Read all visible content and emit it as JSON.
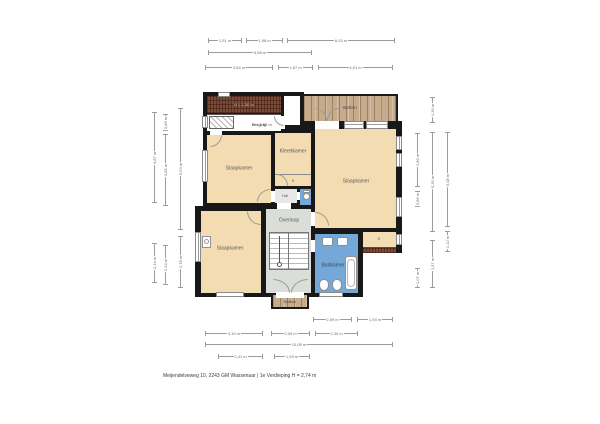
{
  "meta": {
    "caption": "Meijendelseweg 10, 2243 GM Wassenaar | 1e Verdieping H = 2,74 m"
  },
  "colors": {
    "wall": "#181818",
    "room_fill": "#f3dcb1",
    "wet_fill": "#74a8d9",
    "landing_fill": "#dbddd9",
    "hall_fill": "#e6e8e5",
    "roof_fill": "#7c4a36",
    "wood_fill": "#c6ab8c",
    "dim_line": "#9c9c9c",
    "dim_text": "#6e6e6e",
    "label_text": "#5c5c5c"
  },
  "rooms": {
    "slaapkamer_tl": {
      "label": "Slaapkamer"
    },
    "kleedkamer": {
      "label": "Kleedkamer"
    },
    "kast_mid": {
      "label": "K"
    },
    "hal": {
      "label": "Hal"
    },
    "slaapkamer_r": {
      "label": "Slaapkamer"
    },
    "overloop": {
      "label": "Overloop"
    },
    "slaapkamer_bl": {
      "label": "Slaapkamer"
    },
    "badkamer": {
      "label": "Badkamer"
    },
    "kast_r": {
      "label": "K"
    },
    "balkon_top": {
      "label": "Balkon"
    },
    "balkon_bottom": {
      "label": "Balkon"
    },
    "berging": {
      "label": "Berging",
      "height_note": "H = 1,50 m"
    },
    "roof": {
      "height_note": "H < 1,50 m"
    }
  },
  "dimensions": [
    {
      "o": "h",
      "x": 208,
      "y": 40,
      "len": 34,
      "label": "1,51 m"
    },
    {
      "o": "h",
      "x": 246,
      "y": 40,
      "len": 37,
      "label": "1,98 m"
    },
    {
      "o": "h",
      "x": 287,
      "y": 40,
      "len": 108,
      "label": "6,03 m"
    },
    {
      "o": "h",
      "x": 208,
      "y": 52,
      "len": 104,
      "label": "5,58 m"
    },
    {
      "o": "h",
      "x": 205,
      "y": 67,
      "len": 68,
      "label": "3,64 m"
    },
    {
      "o": "h",
      "x": 278,
      "y": 67,
      "len": 35,
      "label": "1,87 m"
    },
    {
      "o": "h",
      "x": 318,
      "y": 67,
      "len": 75,
      "label": "4,01 m"
    },
    {
      "o": "v",
      "x": 154,
      "y": 112,
      "len": 91,
      "label": "4,87 m"
    },
    {
      "o": "v",
      "x": 154,
      "y": 243,
      "len": 40,
      "label": "2,14 m"
    },
    {
      "o": "v",
      "x": 165,
      "y": 114,
      "len": 17,
      "label": "0,86 m"
    },
    {
      "o": "v",
      "x": 165,
      "y": 134,
      "len": 72,
      "label": "3,85 m"
    },
    {
      "o": "v",
      "x": 165,
      "y": 245,
      "len": 40,
      "label": "2,14 m"
    },
    {
      "o": "v",
      "x": 180,
      "y": 108,
      "len": 122,
      "label": "6,53 m"
    },
    {
      "o": "v",
      "x": 180,
      "y": 236,
      "len": 52,
      "label": "2,78 m"
    },
    {
      "o": "v",
      "x": 417,
      "y": 133,
      "len": 54,
      "label": "2,89 m"
    },
    {
      "o": "v",
      "x": 417,
      "y": 191,
      "len": 16,
      "label": "0,86 m"
    },
    {
      "o": "v",
      "x": 417,
      "y": 268,
      "len": 20,
      "label": "1,07 m"
    },
    {
      "o": "v",
      "x": 432,
      "y": 97,
      "len": 26,
      "label": "1,39 m"
    },
    {
      "o": "v",
      "x": 432,
      "y": 132,
      "len": 100,
      "label": "5,35 m"
    },
    {
      "o": "v",
      "x": 432,
      "y": 240,
      "len": 48,
      "label": "2,57 m"
    },
    {
      "o": "v",
      "x": 447,
      "y": 132,
      "len": 95,
      "label": "5,08 m"
    },
    {
      "o": "v",
      "x": 447,
      "y": 231,
      "len": 21,
      "label": "1,12 m"
    },
    {
      "o": "h",
      "x": 313,
      "y": 319,
      "len": 39,
      "label": "2,09 m"
    },
    {
      "o": "h",
      "x": 357,
      "y": 319,
      "len": 36,
      "label": "1,93 m"
    },
    {
      "o": "h",
      "x": 205,
      "y": 333,
      "len": 58,
      "label": "3,10 m"
    },
    {
      "o": "h",
      "x": 271,
      "y": 333,
      "len": 39,
      "label": "2,09 m"
    },
    {
      "o": "h",
      "x": 315,
      "y": 333,
      "len": 43,
      "label": "2,30 m"
    },
    {
      "o": "h",
      "x": 205,
      "y": 344,
      "len": 188,
      "label": "10,05 m"
    },
    {
      "o": "h",
      "x": 218,
      "y": 356,
      "len": 45,
      "label": "2,41 m"
    },
    {
      "o": "h",
      "x": 274,
      "y": 356,
      "len": 36,
      "label": "1,93 m"
    }
  ]
}
